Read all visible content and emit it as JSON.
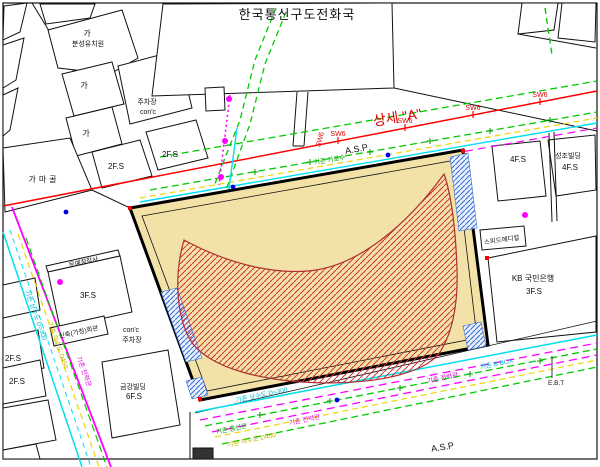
{
  "title": "한국통신구도전화국",
  "colors": {
    "site_fill": "#f2e2a8",
    "red_hatch": "#cc3333",
    "blue_hatch": "#3a6fd8",
    "water_line": "#00e0ee",
    "sewer_line": "#ead800",
    "power_line": "#ff00ff",
    "tree_line": "#00cc00",
    "survey_line": "#ff0000"
  },
  "labels": {
    "detail_a": "상세 \"A\"",
    "asp": "A.S.P",
    "sw6": "SW6",
    "ga": "가",
    "kindergarten": "분성유치원",
    "gamagol": "가마골",
    "parking": "주차장",
    "conc": "con'c",
    "f2s": "2F.S",
    "f3s": "3F.S",
    "f4s": "4F.S",
    "f6s": "6F.S",
    "seongjo": "성조빌딩",
    "speed_medical": "스피드메디칼",
    "kb_bank": "KB 국민은행",
    "munye": "문예창작사",
    "new_building": "신축(가칭)회관",
    "geumgang": "금강빌딩",
    "ebt": "E.B.T"
  },
  "utilities": {
    "water_main": "기존 상수도 D=300",
    "sewer_main": "기존 하수도 D450",
    "telecom": "기존 통신관",
    "power": "기존 전력관",
    "street_trees": "기존 가로수",
    "b_box": "기존 B BOX"
  }
}
